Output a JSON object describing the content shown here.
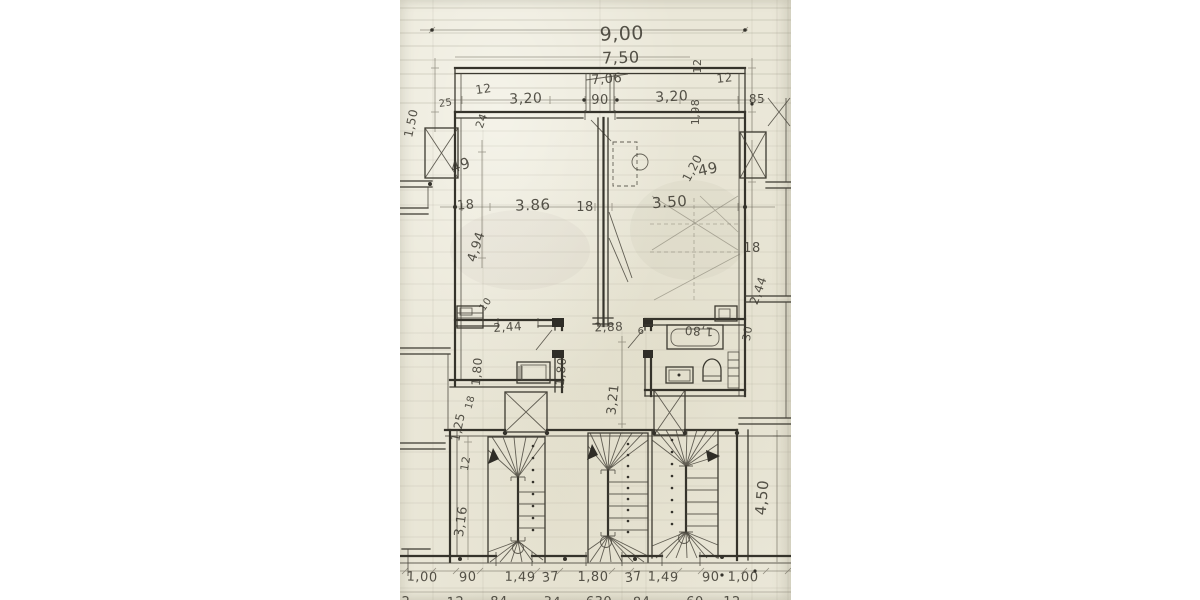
{
  "style_colors": {
    "paper": "#eae7d8",
    "pencil": "#3c3a31"
  },
  "dimension_labels": {
    "overall_top": {
      "width_total": "9,00",
      "width_inner": "7,50",
      "width_crossed": "7,06"
    },
    "top_band": {
      "wall_left": "12",
      "bay_left": "3,20",
      "door_center": "90",
      "bay_right": "3,20",
      "wall_right_rot": "12",
      "wall_right": "12",
      "depth_right": "1,98",
      "pier_right": "85",
      "pier_left": "25",
      "depth_left": "1,50",
      "offset_left": "24"
    },
    "main_rooms": {
      "left_jamb": "49",
      "right_jamb": "49",
      "diag_right": "1,20",
      "wall_a": "18",
      "room_left_width": "3.86",
      "wall_b": "18",
      "room_right_width": "3.50",
      "wall_c": "18",
      "left_depth": "4,94",
      "right_depth": "2,44"
    },
    "middle_band": {
      "small_offset": "10",
      "kitchen_width": "2,44",
      "kitchen_depth_a": "1,80",
      "kitchen_depth_b": "1,80",
      "hall_width": "2,88",
      "wall_small": "6",
      "bath_width": "1,80",
      "bath_offset": "30",
      "hall_depth": "3,21",
      "left_b": "18",
      "left_a": "1,25"
    },
    "stairwell": {
      "left_wall": "12",
      "left_width": "3,16",
      "right_depth": "4,50"
    },
    "bottom_row": [
      "1,00",
      "90",
      "1,49",
      "37",
      "1,80",
      "37",
      "1,49",
      "90",
      "1,00"
    ],
    "bottom_row_cut": [
      "2",
      "12",
      "84",
      "34",
      "630",
      "84",
      "60",
      "12"
    ]
  }
}
